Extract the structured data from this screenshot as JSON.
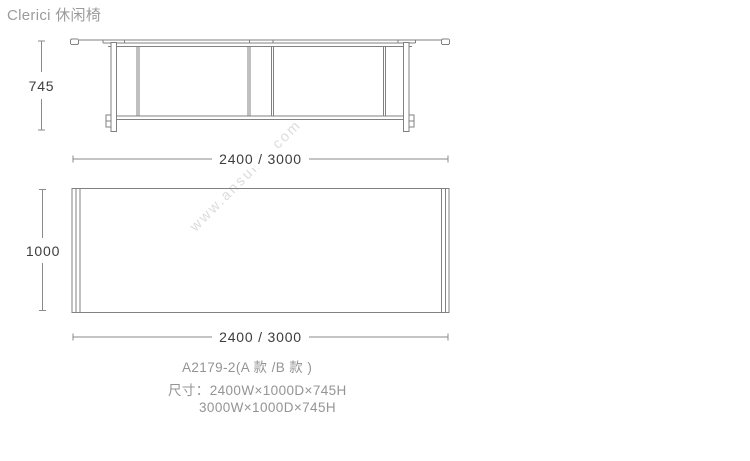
{
  "page": {
    "title": "Clerici 休闲椅"
  },
  "watermark": {
    "text": "www.ansuner.com"
  },
  "drawing": {
    "front_view": {
      "name": "front elevation of table",
      "height_label": "745",
      "width_label": "2400 / 3000"
    },
    "top_view": {
      "name": "plan view of table top",
      "depth_label": "1000",
      "width_label": "2400 / 3000"
    }
  },
  "product_info": {
    "model": "A2179-2(A 款 /B 款 )",
    "size_line1": "尺寸：2400W×1000D×745H",
    "size_line2": "3000W×1000D×745H"
  },
  "colors": {
    "line": "#818181",
    "dimension_text": "#3d3d3d",
    "info_text": "#949494",
    "title_text": "#9b9b9b",
    "watermark_text": "#dcdcdc",
    "background": "#ffffff"
  }
}
